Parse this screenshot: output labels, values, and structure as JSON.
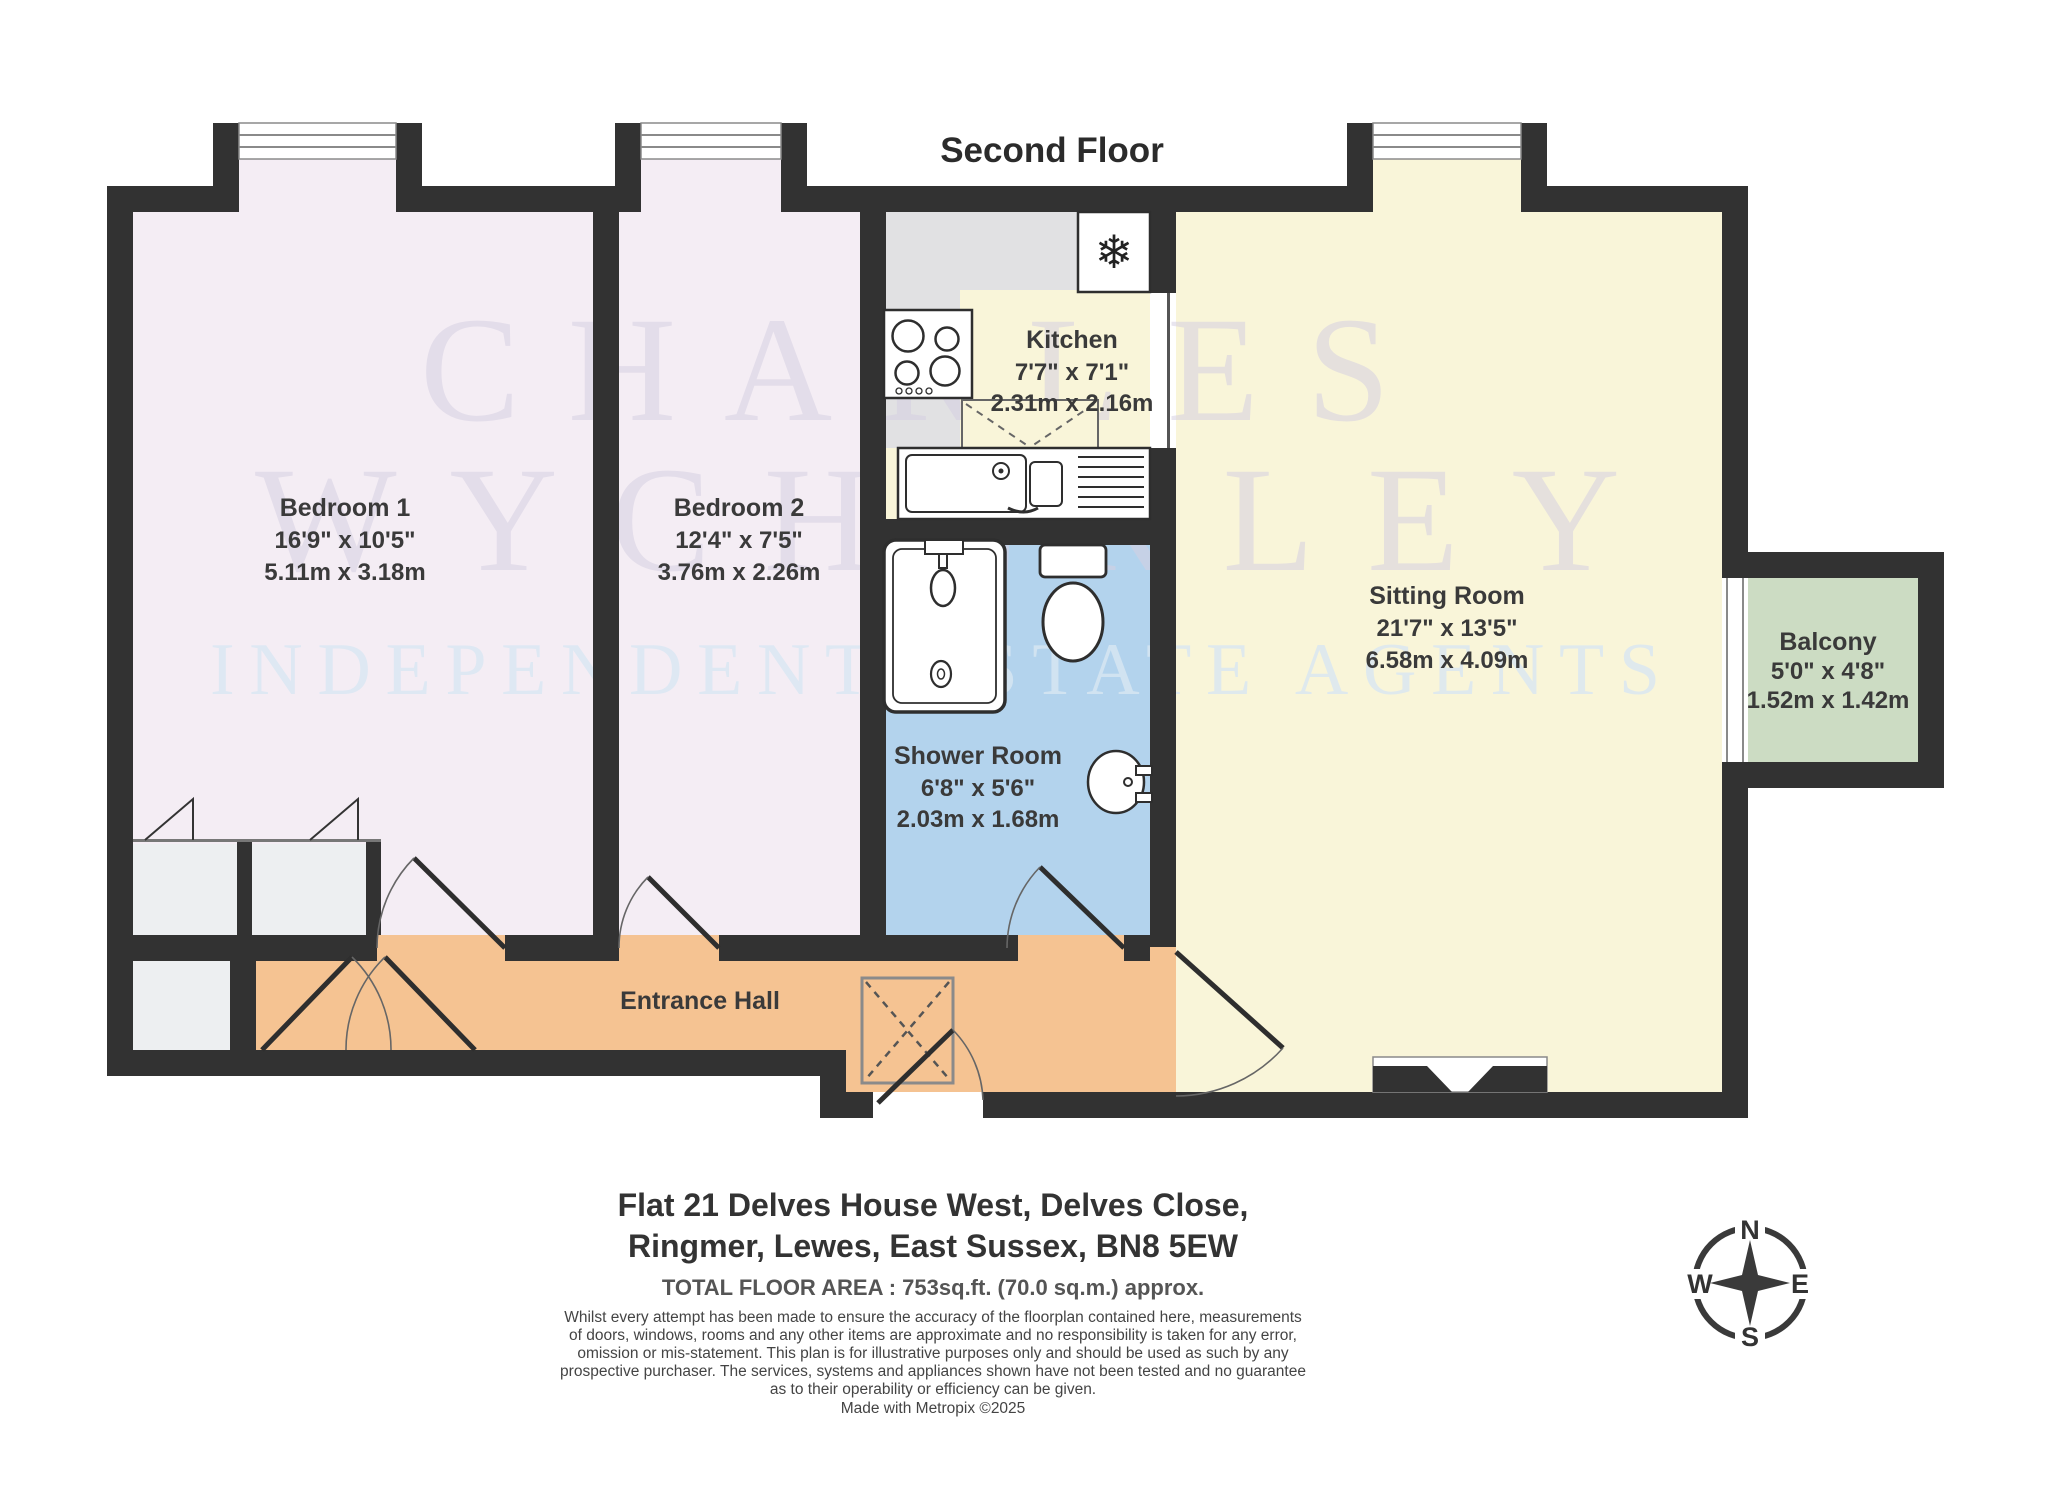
{
  "title": "Second Floor",
  "watermark": {
    "line1": "CHARLES",
    "line2": "WYCHERLEY",
    "line3": "INDEPENDENT ESTATE AGENTS"
  },
  "rooms": {
    "bedroom1": {
      "name": "Bedroom 1",
      "imperial": "16'9\"  x 10'5\"",
      "metric": "5.11m  x 3.18m"
    },
    "bedroom2": {
      "name": "Bedroom 2",
      "imperial": "12'4\"  x 7'5\"",
      "metric": "3.76m  x 2.26m"
    },
    "kitchen": {
      "name": "Kitchen",
      "imperial": "7'7\"  x 7'1\"",
      "metric": "2.31m  x 2.16m"
    },
    "sitting": {
      "name": "Sitting Room",
      "imperial": "21'7\"  x 13'5\"",
      "metric": "6.58m  x 4.09m"
    },
    "shower": {
      "name": "Shower Room",
      "imperial": "6'8\"  x 5'6\"",
      "metric": "2.03m  x 1.68m"
    },
    "balcony": {
      "name": "Balcony",
      "imperial": "5'0\"  x 4'8\"",
      "metric": "1.52m  x 1.42m"
    },
    "hall": {
      "name": "Entrance Hall"
    }
  },
  "address": {
    "line1": "Flat 21 Delves House West, Delves Close,",
    "line2": "Ringmer, Lewes, East Sussex, BN8 5EW"
  },
  "footer": {
    "total_area": "TOTAL FLOOR AREA : 753sq.ft. (70.0 sq.m.) approx.",
    "disclaimer_lines": [
      "Whilst every attempt has been made to ensure the accuracy of the floorplan contained here, measurements",
      "of doors, windows, rooms and any other items are approximate and no responsibility is taken for any error,",
      "omission or mis-statement. This plan is for illustrative purposes only and should be used as such by any",
      "prospective purchaser. The services, systems and appliances shown have not been tested and no guarantee",
      "as to their operability or efficiency can be given."
    ],
    "credit": "Made with Metropix ©2025"
  },
  "compass": {
    "n": "N",
    "e": "E",
    "s": "S",
    "w": "W"
  },
  "icons": {
    "fridge": "snowflake-icon"
  },
  "colors": {
    "wall": "#323232",
    "bedroom_fill": "#f4edf4",
    "kitchen_sitting_fill": "#f9f5d9",
    "counter_grey": "#e1e1e3",
    "shower_fill": "#b3d3ed",
    "hall_fill": "#f5c392",
    "balcony_fill": "#ccdcc3",
    "closet_fill": "#edeff1",
    "watermark_lavender": "#d6d0e2",
    "watermark_blue": "#d9e7f3"
  }
}
